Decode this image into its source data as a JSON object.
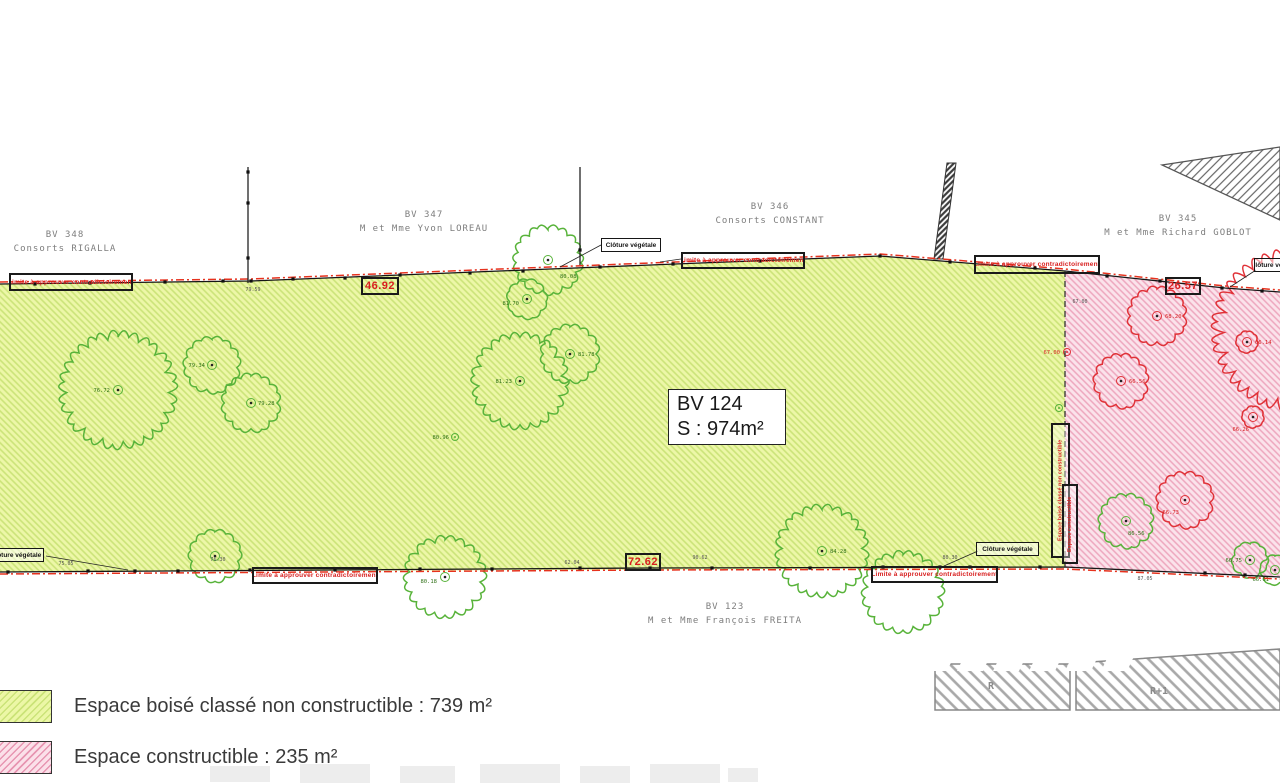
{
  "main_parcel": {
    "id": "BV 124",
    "surface": "S : 974m²"
  },
  "parcels": [
    {
      "id": "BV 348",
      "owner": "Consorts RIGALLA"
    },
    {
      "id": "BV 347",
      "owner": "M et Mme Yvon LOREAU"
    },
    {
      "id": "BV 346",
      "owner": "Consorts CONSTANT"
    },
    {
      "id": "BV 345",
      "owner": "M et Mme Richard GOBLOT"
    },
    {
      "id": "BV 123",
      "owner": "M et Mme François FREITA"
    }
  ],
  "legend": {
    "items": [
      {
        "label": "Espace boisé classé non constructible : 739 m²",
        "swatch": "green",
        "color": "#ecf7a6"
      },
      {
        "label": "Espace constructible : 235 m²",
        "swatch": "pink",
        "color": "#fbe0e9"
      }
    ]
  },
  "elevations": {
    "r": "R",
    "r1": "R+1"
  },
  "boxed_labels": [
    {
      "type": "limite",
      "x": 9,
      "y": 273,
      "w": 124,
      "h": 18,
      "text": "Limite à approuver contradictoirement"
    },
    {
      "type": "dim",
      "x": 361,
      "y": 277,
      "w": 38,
      "h": 18,
      "text": "46.92"
    },
    {
      "type": "cloture",
      "x": 601,
      "y": 238,
      "w": 60,
      "h": 14,
      "text": "Clôture végétale"
    },
    {
      "type": "limite",
      "x": 681,
      "y": 252,
      "w": 124,
      "h": 17,
      "text": "Limite à approuver contradictoirement"
    },
    {
      "type": "limite",
      "x": 974,
      "y": 255,
      "w": 126,
      "h": 19,
      "text": "Limite à approuver contradictoirement"
    },
    {
      "type": "dim",
      "x": 1165,
      "y": 277,
      "w": 36,
      "h": 18,
      "text": "26.57"
    },
    {
      "type": "cloture",
      "x": 1254,
      "y": 258,
      "w": 44,
      "h": 14,
      "text": "Clôture végétale"
    },
    {
      "type": "cloture",
      "x": -12,
      "y": 548,
      "w": 56,
      "h": 14,
      "text": "Clôture végétale"
    },
    {
      "type": "limite",
      "x": 252,
      "y": 567,
      "w": 126,
      "h": 17,
      "text": "Limite à approuver contradictoirement"
    },
    {
      "type": "dim",
      "x": 625,
      "y": 553,
      "w": 36,
      "h": 18,
      "text": "72.62"
    },
    {
      "type": "limite",
      "x": 871,
      "y": 566,
      "w": 127,
      "h": 17,
      "text": "Limite à approuver contradictoirement"
    },
    {
      "type": "cloture",
      "x": 976,
      "y": 542,
      "w": 63,
      "h": 14,
      "text": "Clôture végétale"
    }
  ],
  "vertical_labels": [
    {
      "x": 1051,
      "y": 423,
      "w": 19,
      "h": 135,
      "text": "Espace boisé classé non constructible"
    },
    {
      "x": 1062,
      "y": 484,
      "w": 16,
      "h": 80,
      "text": "Espace constructible"
    }
  ],
  "tiny_labels": [
    {
      "x": 253,
      "y": 291,
      "t": "79.59"
    },
    {
      "x": 66,
      "y": 565,
      "t": "75.05"
    },
    {
      "x": 218,
      "y": 561,
      "t": "76.30"
    },
    {
      "x": 572,
      "y": 564,
      "t": "62.04"
    },
    {
      "x": 700,
      "y": 559,
      "t": "90.62"
    },
    {
      "x": 950,
      "y": 559,
      "t": "80.30"
    },
    {
      "x": 1145,
      "y": 580,
      "t": "87.05"
    },
    {
      "x": 1080,
      "y": 303,
      "t": "67.00"
    }
  ],
  "colors": {
    "red": "#d81f1f",
    "boundary_red": "#e6321e",
    "black": "#161616",
    "tree_green": "#58b33a",
    "tree_green_label": "#2f7016",
    "tree_red": "#e03238",
    "green_fill": "#ecf7a6",
    "pink_fill": "#fbe3eb"
  },
  "plan": {
    "green_zone": [
      [
        0,
        284
      ],
      [
        250,
        281
      ],
      [
        550,
        269
      ],
      [
        700,
        263
      ],
      [
        880,
        256
      ],
      [
        1065,
        271
      ],
      [
        1065,
        568
      ],
      [
        0,
        572
      ]
    ],
    "pink_zone": [
      [
        1065,
        271
      ],
      [
        1140,
        279
      ],
      [
        1225,
        288
      ],
      [
        1280,
        292
      ],
      [
        1280,
        576
      ],
      [
        1065,
        568
      ]
    ],
    "building": [
      [
        1162,
        165
      ],
      [
        1280,
        147
      ],
      [
        1280,
        220
      ]
    ],
    "fence_band": [
      [
        947,
        163
      ],
      [
        956,
        163
      ],
      [
        943,
        259
      ],
      [
        934,
        259
      ]
    ],
    "elev_r": [
      [
        935,
        664
      ],
      [
        1070,
        664
      ],
      [
        1070,
        710
      ],
      [
        935,
        710
      ]
    ],
    "elev_r1": [
      [
        1076,
        663
      ],
      [
        1280,
        649
      ],
      [
        1280,
        710
      ],
      [
        1076,
        710
      ]
    ],
    "top_line": [
      [
        0,
        284
      ],
      [
        250,
        281
      ],
      [
        550,
        269
      ],
      [
        700,
        263
      ],
      [
        880,
        256
      ],
      [
        1065,
        271
      ],
      [
        1140,
        279
      ],
      [
        1225,
        288
      ],
      [
        1280,
        292
      ]
    ],
    "bottom_line": [
      [
        0,
        572
      ],
      [
        650,
        568
      ],
      [
        1065,
        567
      ],
      [
        1280,
        577
      ]
    ],
    "divider": {
      "x": 1065,
      "y1": 271,
      "y2": 568
    },
    "fences": [
      [
        [
          248,
          167
        ],
        [
          248,
          283
        ]
      ],
      [
        [
          580,
          167
        ],
        [
          580,
          265
        ]
      ]
    ],
    "fence_dots": [
      [
        248,
        172
      ],
      [
        248,
        203
      ],
      [
        248,
        258
      ],
      [
        580,
        250
      ]
    ],
    "survey_dots": [
      [
        35,
        284
      ],
      [
        90,
        283
      ],
      [
        165,
        282
      ],
      [
        223,
        281
      ],
      [
        251,
        281
      ],
      [
        293,
        279
      ],
      [
        345,
        278
      ],
      [
        400,
        275
      ],
      [
        470,
        273
      ],
      [
        523,
        271
      ],
      [
        600,
        267
      ],
      [
        673,
        264
      ],
      [
        760,
        261
      ],
      [
        880,
        256
      ],
      [
        950,
        262
      ],
      [
        1035,
        268
      ],
      [
        1107,
        276
      ],
      [
        1160,
        281
      ],
      [
        1222,
        288
      ],
      [
        1262,
        291
      ],
      [
        8,
        572
      ],
      [
        88,
        571
      ],
      [
        135,
        571
      ],
      [
        178,
        571
      ],
      [
        250,
        570
      ],
      [
        335,
        570
      ],
      [
        420,
        569
      ],
      [
        492,
        569
      ],
      [
        580,
        568
      ],
      [
        650,
        568
      ],
      [
        712,
        568
      ],
      [
        810,
        568
      ],
      [
        883,
        567
      ],
      [
        940,
        567
      ],
      [
        970,
        567
      ],
      [
        1040,
        567
      ],
      [
        1205,
        573
      ],
      [
        1245,
        575
      ]
    ],
    "leaders": [
      [
        [
          601,
          245
        ],
        [
          560,
          267
        ]
      ],
      [
        [
          46,
          556
        ],
        [
          128,
          570
        ]
      ],
      [
        [
          978,
          551
        ],
        [
          944,
          566
        ]
      ],
      [
        [
          1256,
          270
        ],
        [
          1230,
          287
        ]
      ],
      [
        [
          681,
          259
        ],
        [
          660,
          262
        ]
      ]
    ],
    "trees": [
      {
        "x": 118,
        "y": 390,
        "r": 57,
        "c": "g",
        "t": "76.72",
        "dx": -8,
        "dy": 2
      },
      {
        "x": 212,
        "y": 365,
        "r": 28,
        "c": "g",
        "t": "79.34",
        "dx": -7,
        "dy": 2
      },
      {
        "x": 251,
        "y": 403,
        "r": 29,
        "c": "g",
        "t": "79.28",
        "dx": 7,
        "dy": 2
      },
      {
        "x": 548,
        "y": 260,
        "r": 34,
        "c": "g",
        "t": "80.08",
        "dx": 12,
        "dy": 18
      },
      {
        "x": 527,
        "y": 299,
        "r": 20,
        "c": "g",
        "t": "81.70",
        "dx": -8,
        "dy": 6
      },
      {
        "x": 520,
        "y": 381,
        "r": 47,
        "c": "g",
        "t": "81.23",
        "dx": -8,
        "dy": 2
      },
      {
        "x": 570,
        "y": 354,
        "r": 29,
        "c": "g",
        "t": "81.78",
        "dx": 8,
        "dy": 2
      },
      {
        "x": 215,
        "y": 556,
        "r": 26,
        "c": "g",
        "t": "",
        "dx": 0,
        "dy": 0
      },
      {
        "x": 445,
        "y": 577,
        "r": 40,
        "c": "g",
        "t": "80.18",
        "dx": -8,
        "dy": 6
      },
      {
        "x": 822,
        "y": 551,
        "r": 45,
        "c": "g",
        "t": "84.28",
        "dx": 8,
        "dy": 2
      },
      {
        "x": 903,
        "y": 592,
        "r": 40,
        "c": "g",
        "t": "",
        "dx": 0,
        "dy": 0,
        "noc": 1
      },
      {
        "x": 1126,
        "y": 521,
        "r": 27,
        "c": "g",
        "t": "86.56",
        "dx": 2,
        "dy": 14
      },
      {
        "x": 1250,
        "y": 560,
        "r": 18,
        "c": "g",
        "t": "66.75",
        "dx": -8,
        "dy": 2
      },
      {
        "x": 1275,
        "y": 570,
        "r": 15,
        "c": "g",
        "t": "66.61",
        "dx": -6,
        "dy": 11
      },
      {
        "x": 1157,
        "y": 316,
        "r": 29,
        "c": "r",
        "t": "68.20",
        "dx": 8,
        "dy": 2
      },
      {
        "x": 1121,
        "y": 381,
        "r": 27,
        "c": "r",
        "t": "66.56",
        "dx": 8,
        "dy": 2
      },
      {
        "x": 1247,
        "y": 342,
        "r": 11,
        "c": "r",
        "t": "66.14",
        "dx": 8,
        "dy": 2
      },
      {
        "x": 1253,
        "y": 417,
        "r": 11,
        "c": "r",
        "t": "66.26",
        "dx": -4,
        "dy": 14
      },
      {
        "x": 1185,
        "y": 500,
        "r": 28,
        "c": "r",
        "t": "66.73",
        "dx": -6,
        "dy": 14
      },
      {
        "x": 1293,
        "y": 330,
        "r": 78,
        "c": "r",
        "t": "",
        "dx": 0,
        "dy": 0,
        "noc": 1
      }
    ],
    "points": [
      {
        "x": 455,
        "y": 437,
        "c": "g",
        "t": "80.96",
        "dx": -6
      },
      {
        "x": 1067,
        "y": 352,
        "c": "r",
        "t": "67.00",
        "dx": -7
      },
      {
        "x": 1059,
        "y": 408,
        "c": "g",
        "t": "",
        "dx": 0
      }
    ],
    "ghosts": [
      [
        [
          933,
          646
        ],
        [
          959,
          646
        ],
        [
          947,
          671
        ],
        [
          921,
          671
        ]
      ],
      [
        [
          969,
          646
        ],
        [
          995,
          646
        ],
        [
          983,
          671
        ],
        [
          957,
          671
        ]
      ],
      [
        [
          1005,
          646
        ],
        [
          1031,
          646
        ],
        [
          1019,
          671
        ],
        [
          993,
          671
        ]
      ],
      [
        [
          1041,
          646
        ],
        [
          1067,
          646
        ],
        [
          1055,
          671
        ],
        [
          1029,
          671
        ]
      ],
      [
        [
          1077,
          646
        ],
        [
          1103,
          646
        ],
        [
          1091,
          671
        ],
        [
          1065,
          671
        ]
      ],
      [
        [
          1113,
          646
        ],
        [
          1139,
          646
        ],
        [
          1127,
          671
        ],
        [
          1101,
          671
        ]
      ]
    ],
    "wm_marks": [
      [
        210,
        766,
        60,
        16
      ],
      [
        300,
        764,
        70,
        19
      ],
      [
        400,
        766,
        55,
        17
      ],
      [
        480,
        764,
        80,
        19
      ],
      [
        580,
        766,
        50,
        17
      ],
      [
        650,
        764,
        70,
        19
      ],
      [
        728,
        768,
        30,
        14
      ]
    ]
  }
}
